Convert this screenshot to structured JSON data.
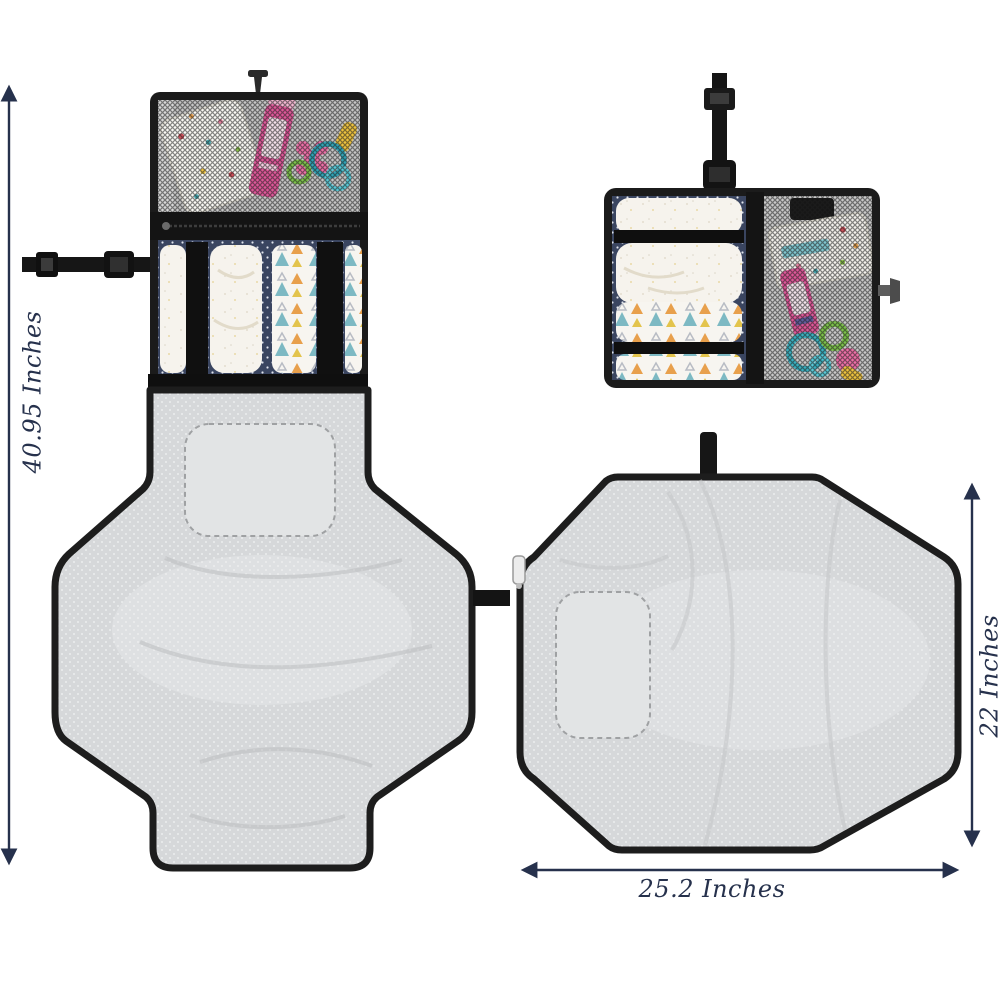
{
  "figure": {
    "kind": "product-dimension-illustration"
  },
  "annotations": {
    "open_height_label": "40.95 Inches",
    "folded_height_label": "22 Inches",
    "open_width_label": "25.2 Inches"
  },
  "colors": {
    "annotation": "#26314c",
    "fabric_black": "#1b1b1b",
    "mat_gray": "#d6d8da",
    "mat_highlight": "#e9ebec",
    "navy_polka": "#3a4560",
    "mesh_gray": "#c6c6c6",
    "diaper_cream": "#f6f3ed",
    "tube_pink": "#e0579a",
    "flower_pink": "#ee6fa8",
    "ring_teal": "#2fa3b6",
    "ring_green": "#7cc24a",
    "toy_yellow": "#eec33e"
  },
  "views": {
    "top_left": "organizer-open-with-stocked-pockets",
    "top_right": "organizer-folded-compact",
    "bottom_left": "changing-mat-unfolded-vertical",
    "bottom_right": "changing-mat-unfolded-horizontal"
  }
}
